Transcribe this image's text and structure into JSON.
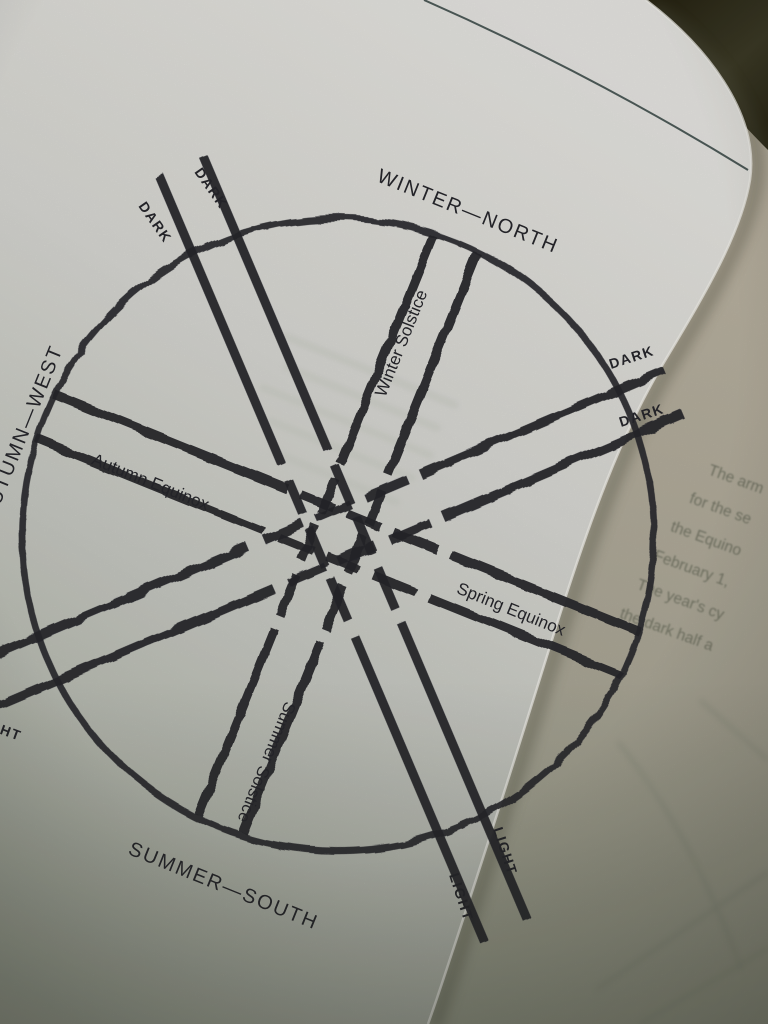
{
  "wheel": {
    "cardinal_labels": {
      "north": "WINTER—NORTH",
      "south": "SUMMER—SOUTH",
      "west": "AUTUMN—WEST"
    },
    "station_labels": {
      "winter_solstice": "Winter Solstice",
      "spring_equinox": "Spring Equinox",
      "summer_solstice": "Summer Solstice",
      "autumn_equinox": "Autumn Equinox"
    },
    "line_end_labels": {
      "nw": [
        "DARK",
        "DARK"
      ],
      "ne": [
        "DARK",
        "DARK"
      ],
      "se": [
        "LIGHT",
        "LIGHT"
      ],
      "sw": [
        "LIGHT"
      ]
    }
  },
  "facing_page": {
    "visible_text_lines": [
      "The arm",
      "for the se",
      "the Equino",
      "February 1,",
      "The year's cy",
      "the dark half a"
    ]
  },
  "colors": {
    "ink": "#26262b",
    "page": "#d8d8d3",
    "facing_page": "#b2ab9a",
    "background_dark": "#322f1f",
    "header_rule": "#4d5a58"
  }
}
